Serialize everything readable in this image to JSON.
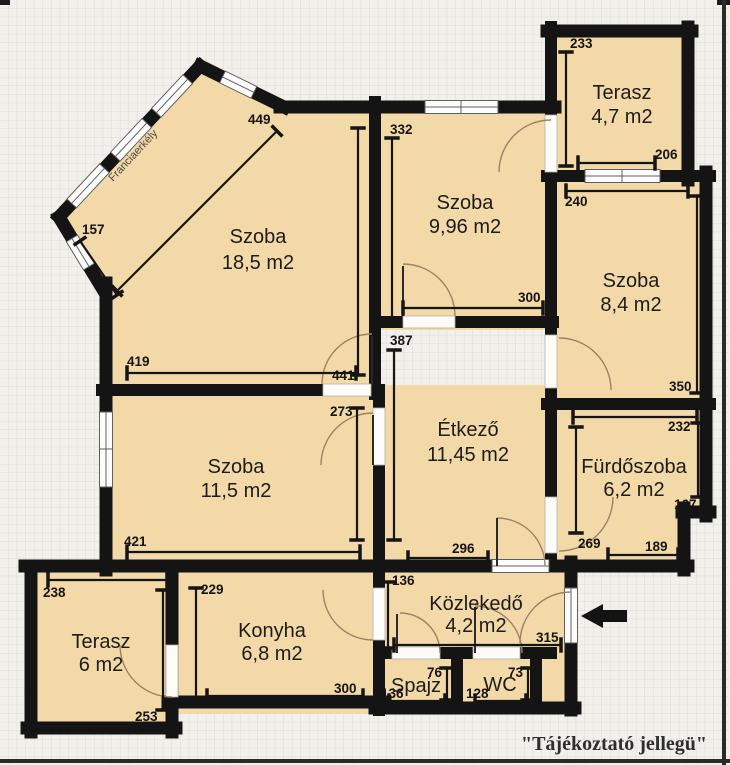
{
  "plan": {
    "balcony_label": "Franciaerkély",
    "rooms": [
      {
        "name": "Szoba",
        "area": "18,5 m2"
      },
      {
        "name": "Szoba",
        "area": "9,96 m2"
      },
      {
        "name": "Terasz",
        "area": "4,7 m2"
      },
      {
        "name": "Szoba",
        "area": "8,4 m2"
      },
      {
        "name": "Étkező",
        "area": "11,45 m2"
      },
      {
        "name": "Szoba",
        "area": "11,5 m2"
      },
      {
        "name": "Fürdőszoba",
        "area": "6,2 m2"
      },
      {
        "name": "Terasz",
        "area": "6 m2"
      },
      {
        "name": "Konyha",
        "area": "6,8 m2"
      },
      {
        "name": "Közlekedő",
        "area": "4,2 m2"
      },
      {
        "name": "Spajz",
        "area": ""
      },
      {
        "name": "WC",
        "area": ""
      }
    ],
    "dims": [
      "449",
      "157",
      "419",
      "441",
      "332",
      "300",
      "233",
      "206",
      "240",
      "350",
      "387",
      "273",
      "421",
      "296",
      "269",
      "232",
      "167",
      "189",
      "136",
      "315",
      "76",
      "136",
      "73",
      "128",
      "300",
      "229",
      "238",
      "253"
    ]
  },
  "footer": {
    "disclaimer": "\"Tájékoztató jellegü\""
  },
  "colors": {
    "room_fill": "#f3d8a8",
    "wall": "#141414",
    "grid_line": "#dddcd7",
    "paper": "#f1f0eb"
  }
}
